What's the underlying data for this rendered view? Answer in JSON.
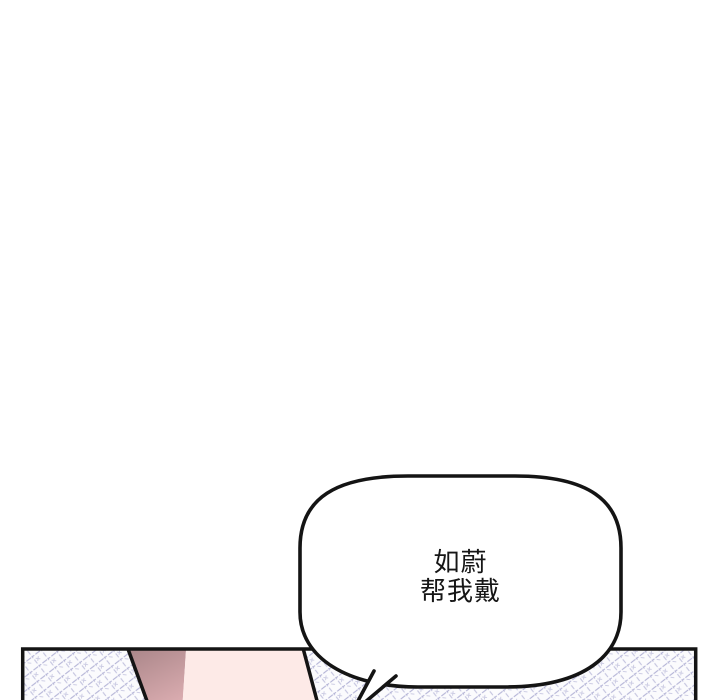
{
  "page": {
    "type": "webtoon-comic-panel",
    "background_color": "#ffffff"
  },
  "speech_bubble": {
    "lines": [
      "如蔚",
      "帮我戴"
    ],
    "fill_color": "#ffffff",
    "outline_color": "#141414",
    "text_color": "#161616"
  },
  "panel": {
    "outline_color": "#141414",
    "screentone": {
      "base_color": "#fbfbfd",
      "line_color": "#a0a0cc"
    },
    "figure": {
      "sleeve_top_color": "#aa8689",
      "sleeve_bottom_color": "#d9abaf",
      "skin_color": "#fdeae7"
    }
  }
}
